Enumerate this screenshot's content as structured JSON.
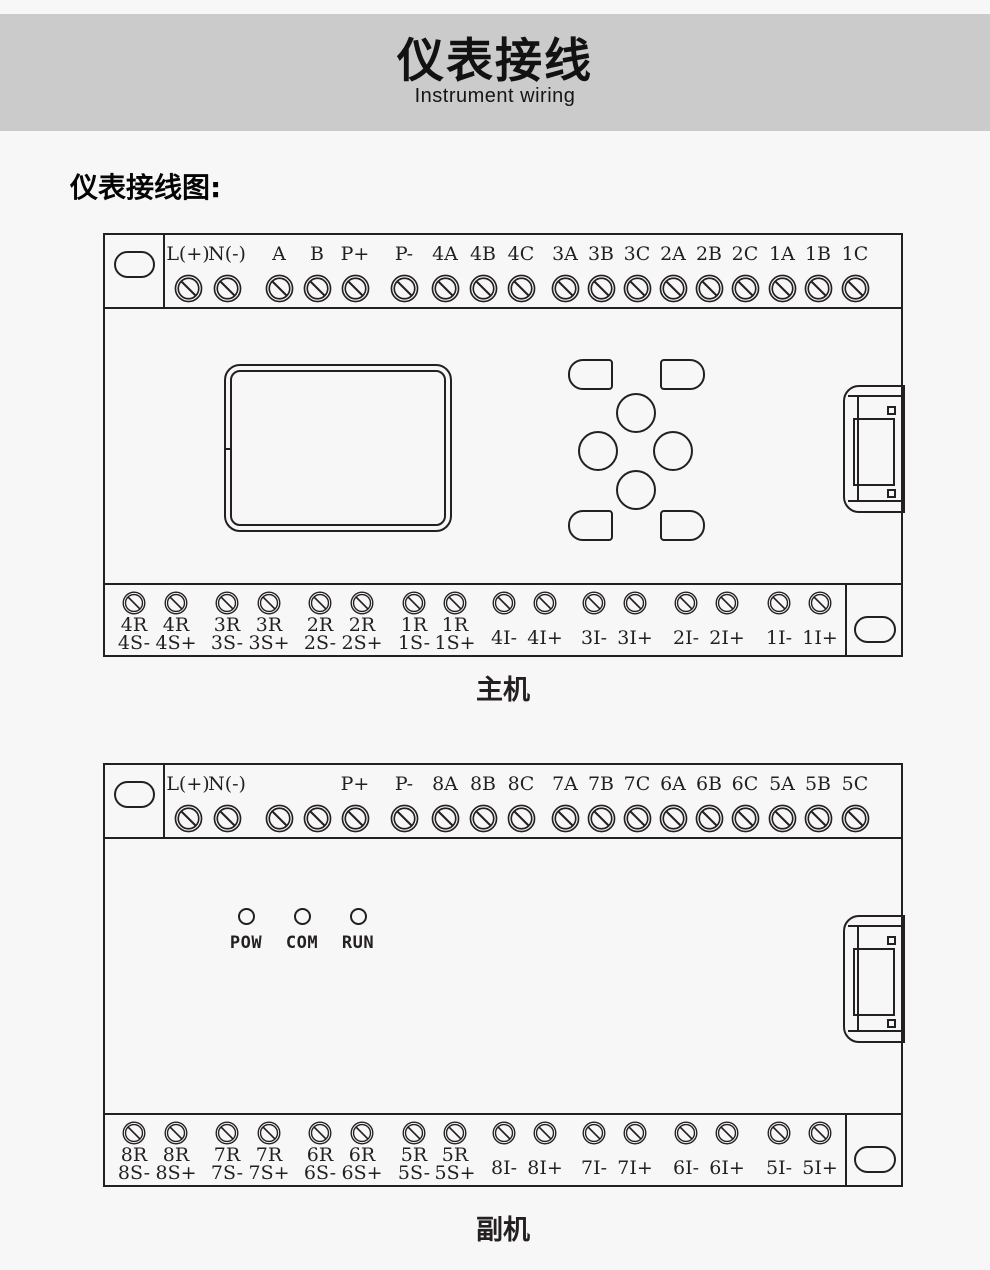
{
  "colors": {
    "ink": "#241f21",
    "page_bg": "#f7f7f7",
    "banner_bg": "#cbcbcb"
  },
  "banner": {
    "title": "仪表接线",
    "subtitle": "Instrument wiring"
  },
  "section_heading": "仪表接线图:",
  "devices": [
    {
      "caption": "主机",
      "top_terminals": [
        "L(+)",
        "N(-)",
        "A",
        "B",
        "P+",
        "P-",
        "4A",
        "4B",
        "4C",
        "3A",
        "3B",
        "3C",
        "2A",
        "2B",
        "2C",
        "1A",
        "1B",
        "1C"
      ],
      "bottom_dual_terminals": [
        [
          "4R",
          "4S-"
        ],
        [
          "4R",
          "4S+"
        ],
        [
          "3R",
          "3S-"
        ],
        [
          "3R",
          "3S+"
        ],
        [
          "2R",
          "2S-"
        ],
        [
          "2R",
          "2S+"
        ],
        [
          "1R",
          "1S-"
        ],
        [
          "1R",
          "1S+"
        ]
      ],
      "bottom_single_terminals": [
        "4I-",
        "4I+",
        "3I-",
        "3I+",
        "2I-",
        "2I+",
        "1I-",
        "1I+"
      ],
      "has_display": true,
      "has_keypad": true,
      "leds": []
    },
    {
      "caption": "副机",
      "top_terminals": [
        "L(+)",
        "N(-)",
        "",
        "",
        "P+",
        "P-",
        "8A",
        "8B",
        "8C",
        "7A",
        "7B",
        "7C",
        "6A",
        "6B",
        "6C",
        "5A",
        "5B",
        "5C"
      ],
      "bottom_dual_terminals": [
        [
          "8R",
          "8S-"
        ],
        [
          "8R",
          "8S+"
        ],
        [
          "7R",
          "7S-"
        ],
        [
          "7R",
          "7S+"
        ],
        [
          "6R",
          "6S-"
        ],
        [
          "6R",
          "6S+"
        ],
        [
          "5R",
          "5S-"
        ],
        [
          "5R",
          "5S+"
        ]
      ],
      "bottom_single_terminals": [
        "8I-",
        "8I+",
        "7I-",
        "7I+",
        "6I-",
        "6I+",
        "5I-",
        "5I+"
      ],
      "has_display": false,
      "has_keypad": false,
      "leds": [
        "POW",
        "COM",
        "RUN"
      ]
    }
  ]
}
